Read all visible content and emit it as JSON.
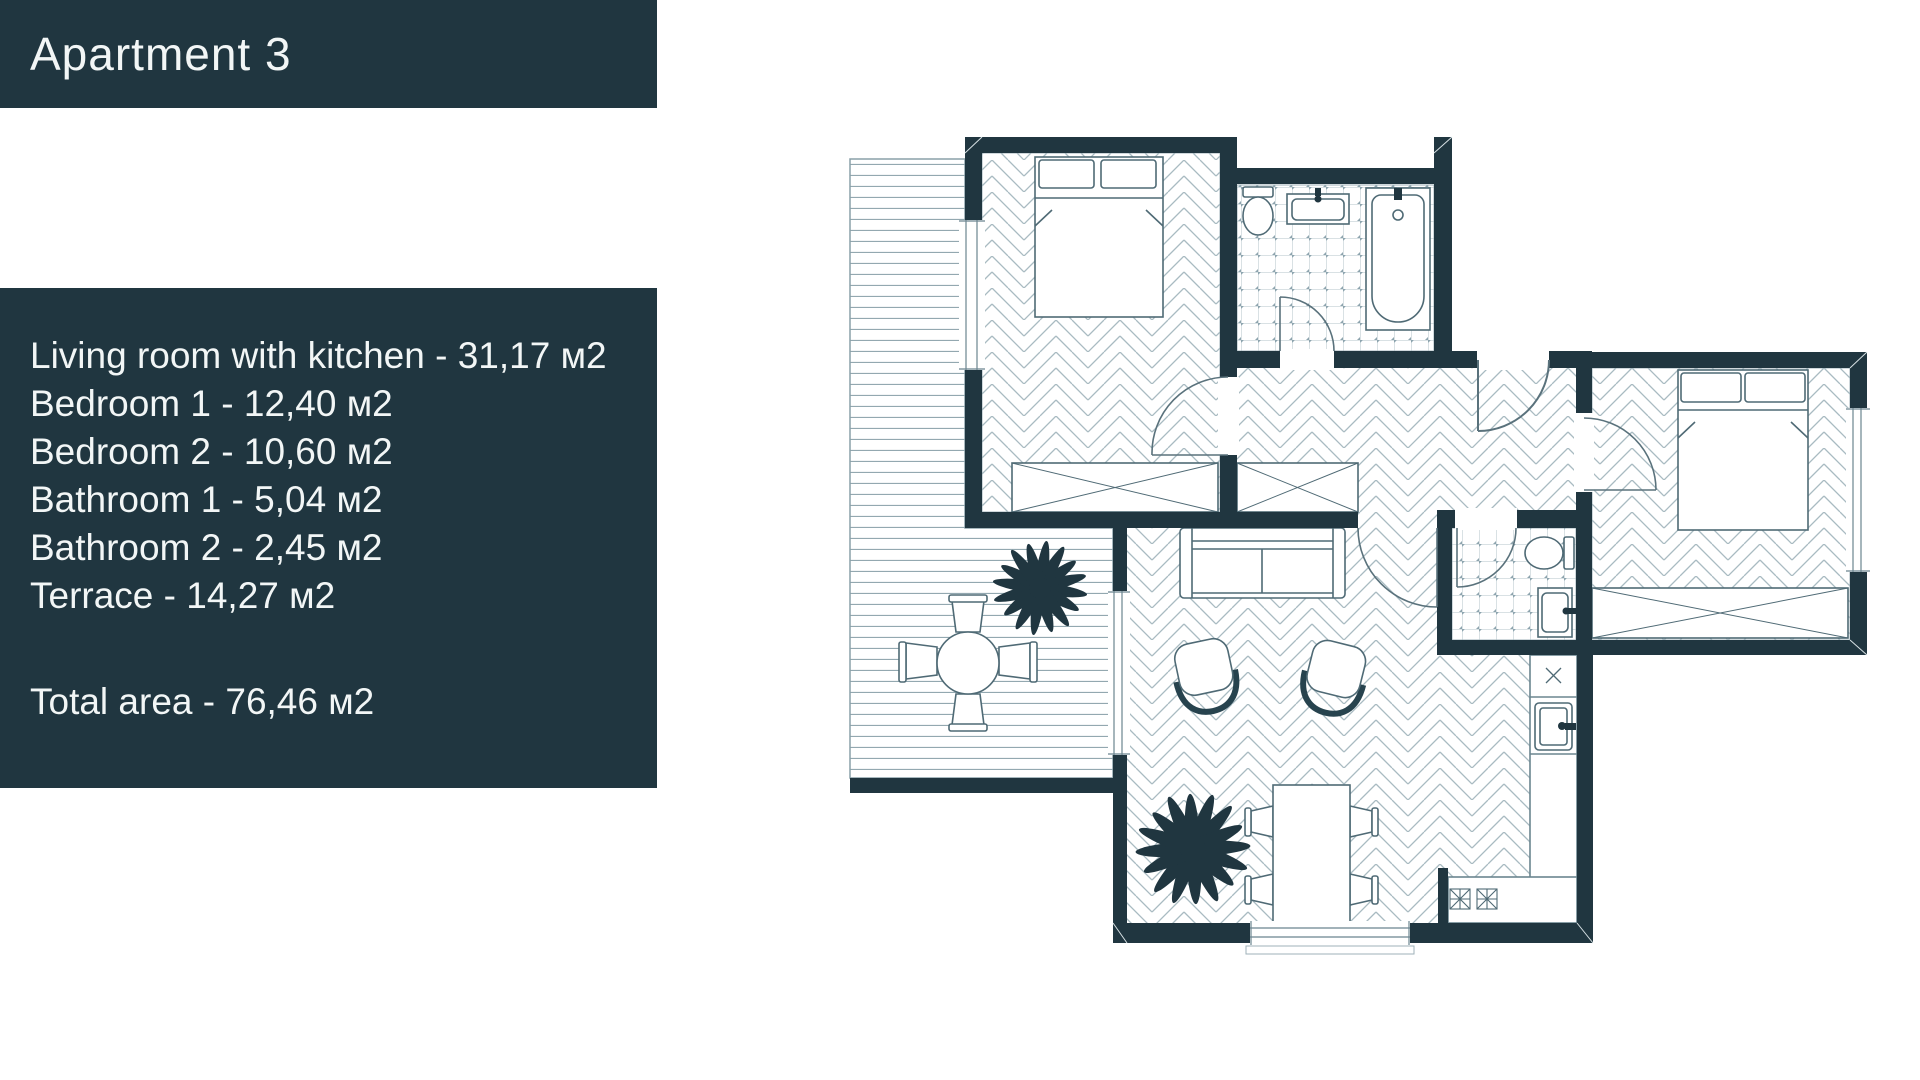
{
  "header": {
    "title": "Apartment 3"
  },
  "info_panel": {
    "rooms": [
      {
        "text": "Living room with kitchen - 31,17 м2"
      },
      {
        "text": "Bedroom 1 - 12,40 м2"
      },
      {
        "text": "Bedroom 2 - 10,60 м2"
      },
      {
        "text": "Bathroom 1 - 5,04 м2"
      },
      {
        "text": "Bathroom 2 - 2,45 м2"
      },
      {
        "text": "Terrace - 14,27 м2"
      }
    ],
    "total": {
      "text": "Total area - 76,46 м2"
    }
  },
  "colors": {
    "panel_background": "#203640",
    "wall": "#203640",
    "panel_text": "#f2f6f6",
    "floor_line": "#a9bbc2",
    "decking_line": "#93a8b0",
    "tile_line": "#b3c3c9",
    "furniture_line": "#4f6a75",
    "page_background": "#ffffff"
  }
}
